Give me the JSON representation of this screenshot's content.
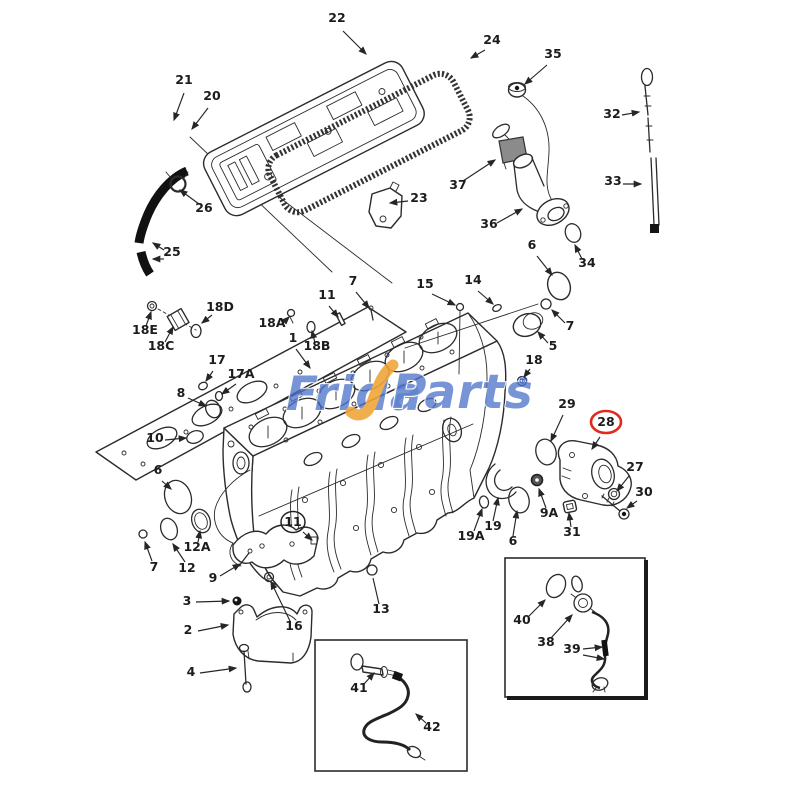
{
  "watermark": {
    "part1": "Frida",
    "part2": "Parts",
    "reg": "®",
    "blue": "#4d74c9",
    "yellow": "#f0a63a"
  },
  "accent_colors": {
    "highlight_circle": "#e02a1e",
    "line_art": "#2b2b2b"
  },
  "callouts": [
    {
      "label": "22",
      "x": 337,
      "y": 22,
      "a": [
        [
          343,
          31,
          366,
          54
        ]
      ]
    },
    {
      "label": "21",
      "x": 184,
      "y": 84,
      "a": [
        [
          184,
          93,
          174,
          120
        ]
      ]
    },
    {
      "label": "20",
      "x": 212,
      "y": 100,
      "a": [
        [
          208,
          108,
          192,
          129
        ]
      ]
    },
    {
      "label": "24",
      "x": 492,
      "y": 44,
      "a": [
        [
          485,
          50,
          471,
          58
        ]
      ]
    },
    {
      "label": "26",
      "x": 204,
      "y": 212,
      "a": [
        [
          199,
          204,
          180,
          190
        ]
      ]
    },
    {
      "label": "25",
      "x": 172,
      "y": 256,
      "a": [
        [
          164,
          250,
          153,
          243
        ],
        [
          164,
          259,
          153,
          259
        ]
      ]
    },
    {
      "label": "23",
      "x": 419,
      "y": 202,
      "a": [
        [
          408,
          201,
          390,
          203
        ]
      ]
    },
    {
      "label": "35",
      "x": 553,
      "y": 58,
      "a": [
        [
          547,
          65,
          525,
          84
        ]
      ]
    },
    {
      "label": "37",
      "x": 458,
      "y": 189,
      "a": [
        [
          463,
          181,
          495,
          160
        ]
      ]
    },
    {
      "label": "36",
      "x": 489,
      "y": 228,
      "a": [
        [
          497,
          223,
          522,
          209
        ]
      ]
    },
    {
      "label": "34",
      "x": 587,
      "y": 267,
      "a": [
        [
          582,
          259,
          575,
          245
        ]
      ]
    },
    {
      "label": "32",
      "x": 612,
      "y": 118,
      "a": [
        [
          622,
          115,
          639,
          112
        ]
      ]
    },
    {
      "label": "33",
      "x": 613,
      "y": 185,
      "a": [
        [
          623,
          184,
          641,
          184
        ]
      ]
    },
    {
      "label": "6",
      "x": 532,
      "y": 249,
      "a": [
        [
          537,
          256,
          552,
          275
        ]
      ]
    },
    {
      "label": "14",
      "x": 473,
      "y": 284,
      "a": [
        [
          478,
          291,
          493,
          304
        ]
      ]
    },
    {
      "label": "15",
      "x": 425,
      "y": 288,
      "a": [
        [
          432,
          294,
          455,
          305
        ]
      ]
    },
    {
      "label": "7",
      "x": 570,
      "y": 330,
      "a": [
        [
          565,
          323,
          552,
          310
        ]
      ]
    },
    {
      "label": "5",
      "x": 553,
      "y": 350,
      "a": [
        [
          548,
          343,
          538,
          332
        ]
      ]
    },
    {
      "label": "18",
      "x": 534,
      "y": 364,
      "a": [
        [
          530,
          369,
          524,
          377
        ]
      ]
    },
    {
      "label": "11",
      "x": 327,
      "y": 299,
      "a": [
        [
          329,
          306,
          338,
          317
        ]
      ]
    },
    {
      "label": "7",
      "x": 353,
      "y": 285,
      "a": [
        [
          356,
          292,
          369,
          308
        ]
      ]
    },
    {
      "label": "18A",
      "x": 272,
      "y": 327,
      "a": [
        [
          282,
          324,
          289,
          317
        ]
      ]
    },
    {
      "label": "18B",
      "x": 317,
      "y": 350,
      "a": [
        [
          315,
          343,
          312,
          331
        ]
      ]
    },
    {
      "label": "1",
      "x": 293,
      "y": 342,
      "a": [
        [
          296,
          349,
          310,
          368
        ]
      ]
    },
    {
      "label": "18D",
      "x": 220,
      "y": 311,
      "a": [
        [
          212,
          315,
          202,
          323
        ]
      ]
    },
    {
      "label": "18E",
      "x": 145,
      "y": 334,
      "a": [
        [
          146,
          326,
          151,
          312
        ]
      ]
    },
    {
      "label": "18C",
      "x": 161,
      "y": 350,
      "a": [
        [
          165,
          342,
          173,
          327
        ]
      ]
    },
    {
      "label": "17",
      "x": 217,
      "y": 364,
      "a": [
        [
          213,
          371,
          206,
          381
        ]
      ]
    },
    {
      "label": "17A",
      "x": 241,
      "y": 378,
      "a": [
        [
          236,
          384,
          222,
          394
        ]
      ]
    },
    {
      "label": "8",
      "x": 181,
      "y": 397,
      "a": [
        [
          188,
          398,
          206,
          406
        ]
      ]
    },
    {
      "label": "10",
      "x": 155,
      "y": 442,
      "a": [
        [
          165,
          440,
          186,
          438
        ]
      ]
    },
    {
      "label": "6",
      "x": 158,
      "y": 474,
      "a": [
        [
          162,
          481,
          171,
          489
        ]
      ]
    },
    {
      "label": "7",
      "x": 154,
      "y": 571,
      "a": [
        [
          152,
          561,
          145,
          542
        ]
      ]
    },
    {
      "label": "12",
      "x": 187,
      "y": 572,
      "a": [
        [
          185,
          562,
          173,
          544
        ]
      ]
    },
    {
      "label": "12A",
      "x": 197,
      "y": 551,
      "a": [
        [
          198,
          542,
          200,
          531
        ]
      ]
    },
    {
      "label": "9",
      "x": 213,
      "y": 582,
      "a": [
        [
          220,
          576,
          240,
          564
        ]
      ]
    },
    {
      "label": "3",
      "x": 187,
      "y": 605,
      "a": [
        [
          196,
          602,
          229,
          601
        ]
      ]
    },
    {
      "label": "2",
      "x": 188,
      "y": 634,
      "a": [
        [
          198,
          631,
          228,
          625
        ]
      ]
    },
    {
      "label": "4",
      "x": 191,
      "y": 676,
      "a": [
        [
          200,
          673,
          236,
          668
        ]
      ]
    },
    {
      "label": "16",
      "x": 294,
      "y": 630,
      "a": [
        [
          290,
          621,
          271,
          582
        ]
      ]
    },
    {
      "label": "13",
      "x": 381,
      "y": 613,
      "p": [
        [
          379,
          604,
          373,
          578
        ]
      ]
    },
    {
      "label": "41",
      "x": 359,
      "y": 692,
      "a": [
        [
          364,
          684,
          374,
          673
        ]
      ]
    },
    {
      "label": "42",
      "x": 432,
      "y": 731,
      "a": [
        [
          426,
          723,
          416,
          714
        ]
      ]
    },
    {
      "label": "40",
      "x": 522,
      "y": 624,
      "a": [
        [
          529,
          616,
          545,
          600
        ]
      ]
    },
    {
      "label": "38",
      "x": 546,
      "y": 646,
      "a": [
        [
          551,
          638,
          572,
          615
        ]
      ]
    },
    {
      "label": "39",
      "x": 572,
      "y": 653,
      "a": [
        [
          583,
          649,
          602,
          647
        ],
        [
          583,
          655,
          604,
          659
        ]
      ]
    },
    {
      "label": "29",
      "x": 567,
      "y": 408,
      "a": [
        [
          563,
          415,
          551,
          441
        ]
      ]
    },
    {
      "label": "28",
      "x": 606,
      "y": 426,
      "c": "red",
      "a": [
        [
          600,
          437,
          592,
          449
        ]
      ]
    },
    {
      "label": "27",
      "x": 635,
      "y": 471,
      "a": [
        [
          629,
          476,
          617,
          491
        ]
      ]
    },
    {
      "label": "30",
      "x": 644,
      "y": 496,
      "a": [
        [
          637,
          501,
          627,
          508
        ]
      ]
    },
    {
      "label": "9A",
      "x": 549,
      "y": 517,
      "a": [
        [
          546,
          508,
          539,
          489
        ]
      ]
    },
    {
      "label": "31",
      "x": 572,
      "y": 536,
      "a": [
        [
          571,
          527,
          569,
          513
        ]
      ]
    },
    {
      "label": "19",
      "x": 493,
      "y": 530,
      "a": [
        [
          493,
          521,
          498,
          498
        ]
      ]
    },
    {
      "label": "19A",
      "x": 471,
      "y": 540,
      "a": [
        [
          474,
          531,
          482,
          509
        ]
      ]
    },
    {
      "label": "6",
      "x": 513,
      "y": 545,
      "a": [
        [
          513,
          536,
          517,
          511
        ]
      ]
    },
    {
      "label": "11",
      "x": 293,
      "y": 526,
      "c": "dark",
      "a": [
        [
          303,
          532,
          312,
          540
        ]
      ]
    }
  ]
}
